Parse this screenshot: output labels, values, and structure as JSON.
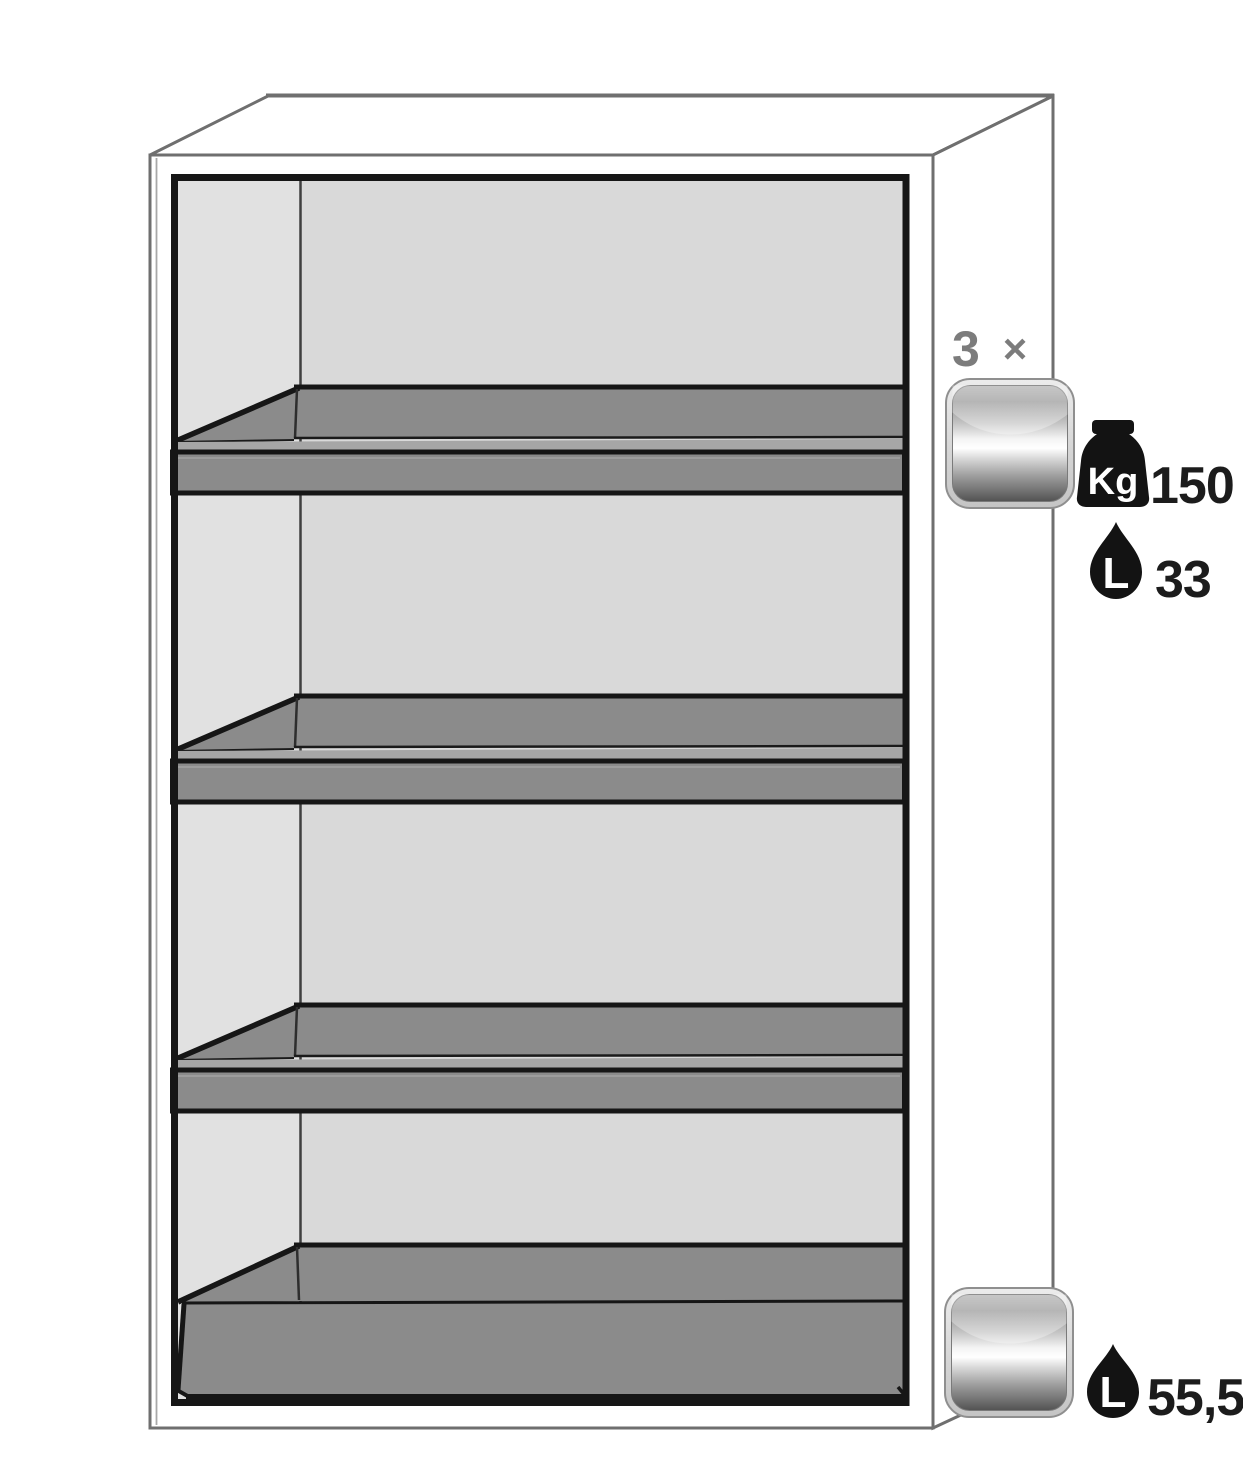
{
  "diagram": {
    "kind": "safety-cabinet-interior-equipment",
    "badges": {
      "shelf_count_number": "3",
      "shelf_count_times": "×",
      "kg_unit": "Kg",
      "shelf_load_kg": "150",
      "liter_unit": "L",
      "shelf_sump_liters": "33",
      "bottom_liter_unit": "L",
      "bottom_sump_liters": "55,5"
    },
    "colors": {
      "cabinet_white": "#ffffff",
      "wall_back": "#d9d9d9",
      "wall_left": "#e1e1e1",
      "tray": "#8b8b8b",
      "tray_lip": "#a6a6a6",
      "outline_gray": "#6f6f6f",
      "frame_black": "#161616",
      "label_gray": "#7c7c7c",
      "text_dark": "#1c1c1c",
      "icon_black": "#131313"
    }
  }
}
